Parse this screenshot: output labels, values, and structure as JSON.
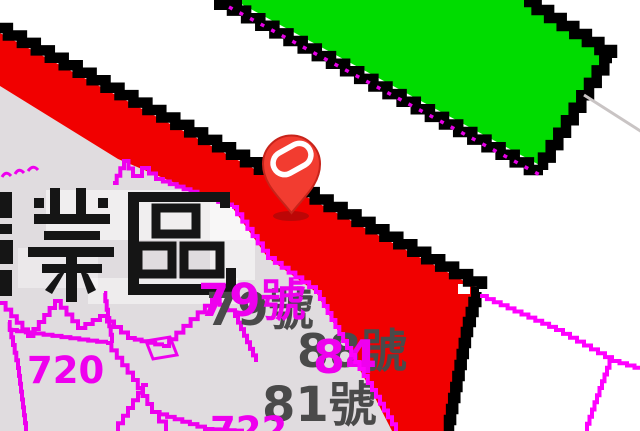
{
  "map": {
    "zone_label": "業區",
    "labels": {
      "parcel_720": "720",
      "parcel_722": "722",
      "address_79": "79號",
      "address_79_overlay": "79號",
      "address_88": "88號",
      "address_84_overlay": "84",
      "address_81": "81號"
    },
    "pin": {
      "icon": "map-pin-icon",
      "color": "#f23c30",
      "glyph": "stadium-ring"
    },
    "colors": {
      "zone_green": "#00dc00",
      "road_band_red": "#f10000",
      "boundary_black": "#000000",
      "parcel_line_magenta": "#ee00ee",
      "parcel_line_bright": "#ff00ff",
      "parcel_fill_gray": "#e0dcdf",
      "address_label_gray": "#4a4a4a",
      "background_white": "#ffffff",
      "faint_line_gray": "#c9c4c4",
      "pin_shadow_red": "#7c0d0d"
    }
  }
}
